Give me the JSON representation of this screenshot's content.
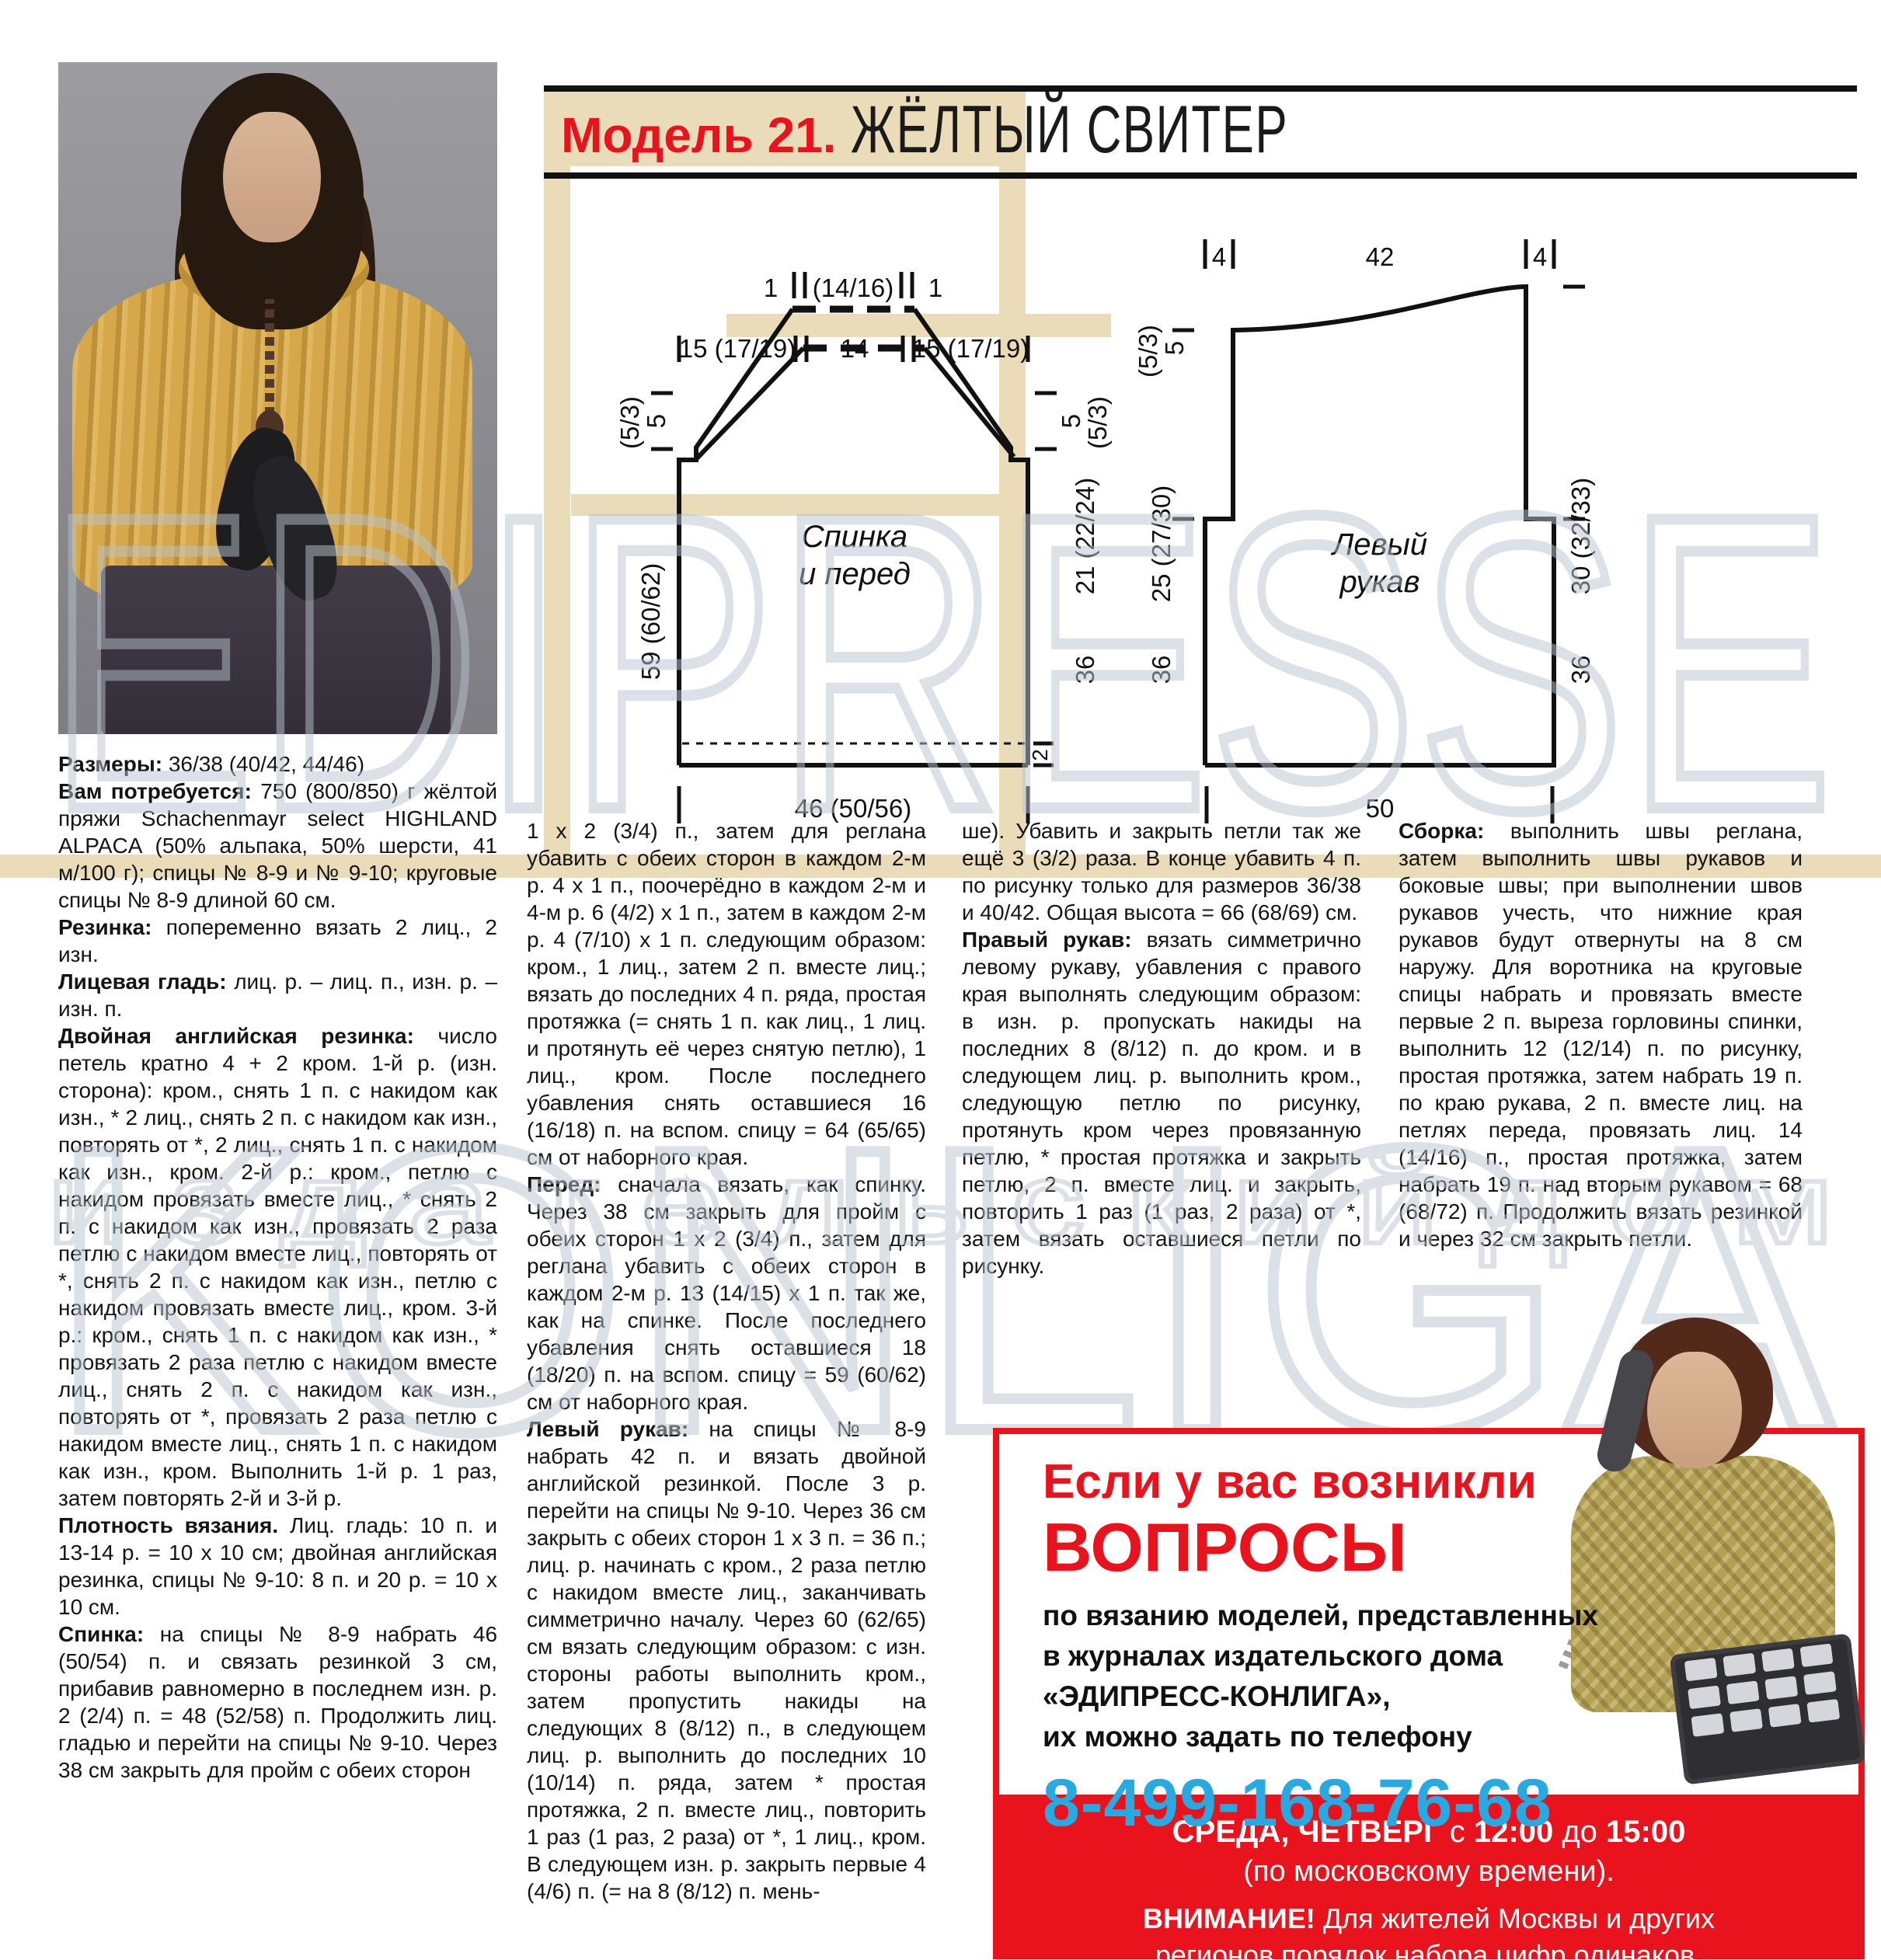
{
  "title": {
    "model": "Модель 21.",
    "name": "ЖЁЛТЫЙ СВИТЕР"
  },
  "watermark": {
    "line1": "EDIPRESSE",
    "line2": "KONLIGA",
    "line3": "и з д а т е л ь с к и й   д о м"
  },
  "colors": {
    "accent_red": "#e8131c",
    "phone_blue": "#29a9e2",
    "beige": "#eadcb9",
    "watermark_gray": "#b9c4ce"
  },
  "diagrams": {
    "back": {
      "caption_line1": "Спинка",
      "caption_line2": "и перед",
      "top_left_one": "1",
      "top_neck": "(14/16)",
      "top_right_one": "1",
      "row_left": "15 (17/19)",
      "row_center": "14",
      "row_right": "15 (17/19)",
      "left_top_a": "(5/3)",
      "left_top_b": "5",
      "left_height": "59 (60/62)",
      "right_top_a": "5",
      "right_top_b": "(5/3)",
      "right_raglan": "21 (22/24)",
      "right_body": "36",
      "hem": "2",
      "bottom_width": "46 (50/56)"
    },
    "sleeve": {
      "caption_line1": "Левый",
      "caption_line2": "рукав",
      "top_left": "4",
      "top_center": "42",
      "top_right": "4",
      "left_top_a": "(5/3)",
      "left_top_b": "5",
      "left_cap": "25 (27/30)",
      "left_body": "36",
      "right_cap": "30 (32/33)",
      "right_body": "36",
      "bottom_width": "50"
    }
  },
  "columns": {
    "col1": [
      {
        "lead": "Размеры:",
        "text": "36/38 (40/42, 44/46)"
      },
      {
        "lead": "Вам потребуется:",
        "text": "750 (800/850) г жёлтой пряжи Schachenmayr select HIGHLAND ALPACA (50% альпака, 50% шерсти, 41 м/100 г); спицы № 8-9 и № 9-10; круговые спицы № 8-9 длиной 60 см."
      },
      {
        "lead": "Резинка:",
        "text": "попеременно вязать 2 лиц., 2 изн."
      },
      {
        "lead": "Лицевая гладь:",
        "text": "лиц. р. – лиц. п., изн. р. – изн. п."
      },
      {
        "lead": "Двойная английская резинка:",
        "text": "число петель кратно 4 + 2 кром. 1-й р. (изн. сторона): кром., снять 1 п. с накидом как изн., * 2 лиц., снять 2 п. с накидом как изн., повторять от *, 2 лиц., снять 1 п. с накидом как изн., кром. 2-й р.: кром., петлю с накидом провязать вместе лиц., * снять 2 п. с накидом как изн., провязать 2 раза петлю с накидом вместе лиц., повторять от *, снять 2 п. с накидом как изн., петлю с накидом провязать вместе лиц., кром. 3-й р.: кром., снять 1 п. с накидом как изн., * провязать 2 раза петлю с накидом вместе лиц., снять 2 п. с накидом как изн., повторять от *, провязать 2 раза петлю с накидом вместе лиц., снять 1 п. с накидом как изн., кром. Выполнить 1-й р. 1 раз, затем повторять 2-й и 3-й р."
      },
      {
        "lead": "Плотность вязания.",
        "text": "Лиц. гладь: 10 п. и 13-14 р. = 10 х 10 см; двойная английская резинка, спицы № 9-10: 8 п. и 20 р. = 10 х 10 см."
      },
      {
        "lead": "Спинка:",
        "text": "на спицы № 8-9 набрать 46 (50/54) п. и связать резинкой 3 см, прибавив равномерно в последнем изн. р. 2 (2/4) п. = 48 (52/58) п. Продолжить лиц. гладью и перейти на спицы № 9-10. Через 38 см закрыть для пройм с обеих сторон"
      }
    ],
    "col2": [
      {
        "lead": "",
        "text": "1 х 2 (3/4) п., затем для реглана убавить с обеих сторон в каждом 2-м р. 4 х 1 п., поочерёдно в каждом 2-м и 4-м р. 6 (4/2) х 1 п., затем в каждом 2-м р. 4 (7/10) х 1 п. следующим образом: кром., 1 лиц., затем 2 п. вместе лиц.; вязать до последних 4 п. ряда, простая протяжка (= снять 1 п. как лиц., 1 лиц. и протянуть её через снятую петлю), 1 лиц., кром. После последнего убавления снять оставшиеся 16 (16/18) п. на вспом. спицу = 64 (65/65) см от наборного края."
      },
      {
        "lead": "Перед:",
        "text": "сначала вязать, как спинку. Через 38 см закрыть для пройм с обеих сторон 1 х 2 (3/4) п., затем для реглана убавить с обеих сторон в каждом 2-м р. 13 (14/15) х 1 п. так же, как на спинке. После последнего убавления снять оставшиеся 18 (18/20) п. на вспом. спицу = 59 (60/62) см от наборного края."
      },
      {
        "lead": "Левый рукав:",
        "text": "на спицы № 8-9 набрать 42 п. и вязать двойной английской резинкой. После 3 р. перейти на спицы № 9-10. Через 36 см закрыть с обеих сторон 1 х 3 п. = 36 п.; лиц. р. начинать с кром., 2 раза петлю с накидом вместе лиц., заканчивать симметрично началу. Через 60 (62/65) см вязать следующим образом: с изн. стороны работы выполнить кром., затем пропустить накиды на следующих 8 (8/12) п., в следующем лиц. р. выполнить до последних 10 (10/14) п. ряда, затем * простая протяжка, 2 п. вместе лиц., повторить 1 раз (1 раз, 2 раза) от *, 1 лиц., кром. В следующем изн. р. закрыть первые 4 (4/6) п. (= на 8 (8/12) п. мень-"
      }
    ],
    "col3": [
      {
        "lead": "",
        "text": "ше). Убавить и закрыть петли так же ещё 3 (3/2) раза. В конце убавить 4 п. по рисунку только для размеров 36/38 и 40/42. Общая высота = 66 (68/69) см."
      },
      {
        "lead": "Правый рукав:",
        "text": "вязать симметрично левому рукаву, убавления с правого края выполнять следующим образом: в изн. р. пропускать накиды на последних 8 (8/12) п. до кром. и в следующем лиц. р. выполнить кром., следующую петлю по рисунку, протянуть кром через провязанную петлю, * простая протяжка и закрыть петлю, 2 п. вместе лиц. и закрыть, повторить 1 раз (1 раз, 2 раза) от *, затем вязать оставшиеся петли по рисунку."
      }
    ],
    "col4": [
      {
        "lead": "Сборка:",
        "text": "выполнить швы реглана, затем выполнить швы рукавов и боковые швы; при выполнении швов рукавов учесть, что нижние края рукавов будут отвернуты на 8 см наружу. Для воротника на круговые спицы набрать и провязать вместе первые 2 п. выреза горловины спинки, выполнить 12 (12/14) п. по рисунку, простая протяжка, затем набрать 19 п. по краю рукава, 2 п. вместе лиц. на петлях переда, провязать лиц. 14 (14/16) п., простая протяжка, затем набрать 19 п. над вторым рукавом = 68 (68/72) п. Продолжить вязать резинкой и через 32 см закрыть петли."
      }
    ]
  },
  "ad": {
    "headline1": "Если у вас возникли",
    "headline2": "ВОПРОСЫ",
    "body_line1": "по вязанию моделей, представленных",
    "body_line2": "в журналах издательского дома",
    "body_line3": "«ЭДИПРЕСС-КОНЛИГА»,",
    "body_line4": "их можно задать по телефону",
    "phone": "8-499-168-76-68",
    "band": {
      "l1_bold": "СРЕДА, ЧЕТВЕРГ",
      "l1_mid": " с ",
      "l1_time1": "12:00",
      "l1_mid2": " до ",
      "l1_time2": "15:00",
      "l2": "(по московскому времени).",
      "l3_bold": "ВНИМАНИЕ!",
      "l3_rest": " Для жителей Москвы и других",
      "l4": "регионов порядок набора цифр одинаков."
    }
  }
}
